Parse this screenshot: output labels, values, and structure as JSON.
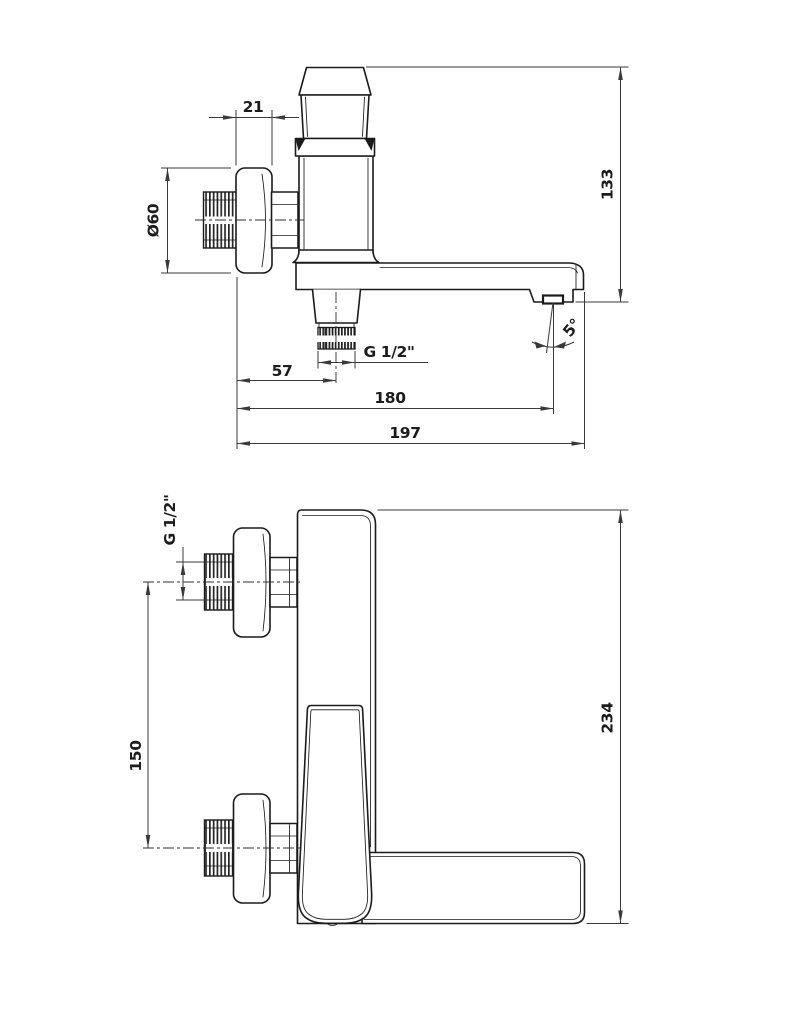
{
  "drawing_type": "faucet-technical-drawing",
  "colors": {
    "background": "#ffffff",
    "part_line": "#1b1b1b",
    "dimension_line": "#3a3a3a",
    "text": "#1c1c1c"
  },
  "side_view": {
    "dimensions": {
      "flange_depth": "21",
      "flange_diameter": "Ø60",
      "height_to_spout_outlet": "133",
      "shower_outlet_thread": "G 1/2\"",
      "spout_angle": "5°",
      "shower_outlet_offset": "57",
      "spout_outlet_reach": "180",
      "total_length": "197"
    }
  },
  "front_view": {
    "dimensions": {
      "inlet_thread": "G 1/2\"",
      "inlet_spacing": "150",
      "total_height": "234"
    }
  }
}
